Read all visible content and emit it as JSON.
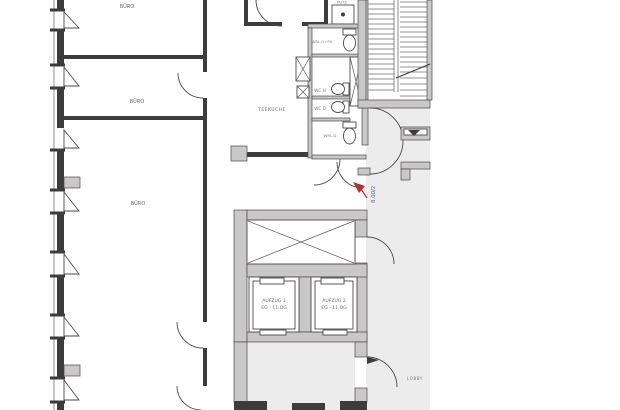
{
  "floorplan": {
    "offices": [
      "BÜRO",
      "BÜRO",
      "BÜRO"
    ],
    "rooms": {
      "teekueche": "TEEKÜCHE",
      "putz": "PUTZ",
      "wrl_h": "WRL.H+PU",
      "wc_h": "WC H",
      "wc_d": "WC D",
      "wrl_d": "WRL.D",
      "lobby": "LOBBY"
    },
    "elevators": [
      {
        "name": "AUFZUG 1",
        "floors": "EG - 11.OG"
      },
      {
        "name": "AUFZUG 2",
        "floors": "EG - 11.OG"
      }
    ],
    "annotations": {
      "exit_width": "8.00/2"
    },
    "colors": {
      "floor_gray": "#edecec",
      "wall_gray": "#c9c7c7",
      "wall_dark": "#3c3c3c",
      "marker_red": "#b8312b",
      "dim_text": "#5a6a7a"
    }
  }
}
